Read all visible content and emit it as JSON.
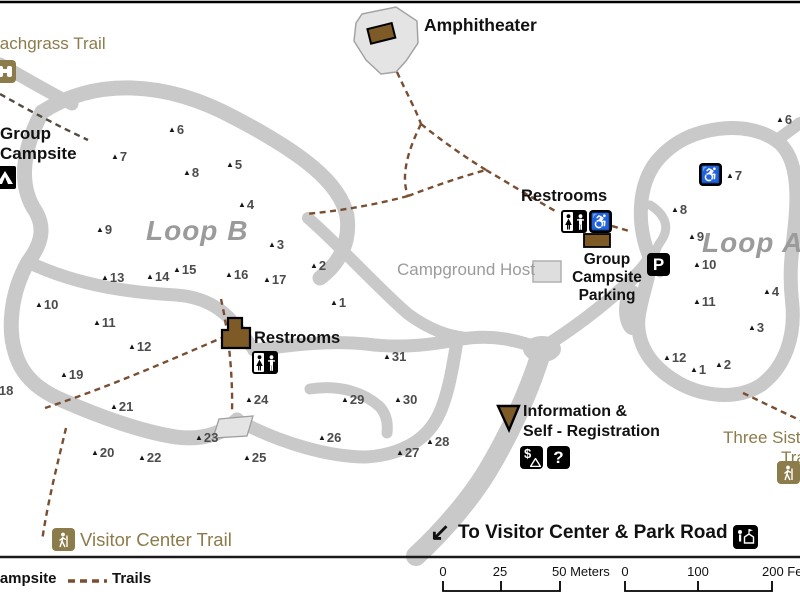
{
  "labels": {
    "beachgrass_trail": "Beachgrass Trail",
    "amphitheater": "Amphitheater",
    "group_campsite_line1": "Group",
    "group_campsite_line2": "Campsite",
    "loop_b": "Loop B",
    "loop_a": "Loop A",
    "restrooms_loop_b": "Restrooms",
    "restrooms_loop_a": "Restrooms",
    "campground_host": "Campground Host",
    "group_campsite_parking_line1": "Group",
    "group_campsite_parking_line2": "Campsite",
    "group_campsite_parking_line3": "Parking",
    "information_line1": "Information &",
    "information_line2": "Self - Registration",
    "three_sisters_line1": "Three Sisters",
    "three_sisters_line2": "Trail",
    "visitor_center_trail": "Visitor Center Trail",
    "to_visitor_center": "To Visitor Center & Park Road"
  },
  "icons": {
    "arrow_sw": "↙",
    "parking": "P",
    "question": "?",
    "dollar": "$",
    "wheelchair": "♿",
    "campsite_triangle": "▲"
  },
  "legend": {
    "campsite": "Campsite",
    "trails": "Trails"
  },
  "scale_bars": {
    "meters": {
      "labels": [
        {
          "text": "0",
          "x": 443,
          "anchor": "middle"
        },
        {
          "text": "25",
          "x": 500,
          "anchor": "middle"
        },
        {
          "text": "50 Meters",
          "x": 552,
          "anchor": "start"
        }
      ]
    },
    "feet": {
      "labels": [
        {
          "text": "0",
          "x": 625,
          "anchor": "middle"
        },
        {
          "text": "100",
          "x": 698,
          "anchor": "middle"
        },
        {
          "text": "200 Feet",
          "x": 762,
          "anchor": "start"
        }
      ]
    }
  },
  "sites": {
    "loop_b": [
      {
        "n": "1",
        "x": 330,
        "y": 296
      },
      {
        "n": "2",
        "x": 310,
        "y": 259
      },
      {
        "n": "3",
        "x": 268,
        "y": 238
      },
      {
        "n": "4",
        "x": 238,
        "y": 198
      },
      {
        "n": "5",
        "x": 226,
        "y": 158
      },
      {
        "n": "6",
        "x": 168,
        "y": 123
      },
      {
        "n": "7",
        "x": 111,
        "y": 150
      },
      {
        "n": "8",
        "x": 183,
        "y": 166
      },
      {
        "n": "9",
        "x": 96,
        "y": 223
      },
      {
        "n": "10",
        "x": 35,
        "y": 298
      },
      {
        "n": "11",
        "x": 93,
        "y": 316
      },
      {
        "n": "12",
        "x": 128,
        "y": 340
      },
      {
        "n": "13",
        "x": 101,
        "y": 271
      },
      {
        "n": "14",
        "x": 146,
        "y": 270
      },
      {
        "n": "15",
        "x": 173,
        "y": 263
      },
      {
        "n": "16",
        "x": 225,
        "y": 268
      },
      {
        "n": "17",
        "x": 263,
        "y": 273
      },
      {
        "n": "18",
        "x": -10,
        "y": 384
      },
      {
        "n": "19",
        "x": 60,
        "y": 368
      },
      {
        "n": "20",
        "x": 91,
        "y": 446
      },
      {
        "n": "21",
        "x": 110,
        "y": 400
      },
      {
        "n": "22",
        "x": 138,
        "y": 451
      },
      {
        "n": "23",
        "x": 195,
        "y": 431
      },
      {
        "n": "24",
        "x": 245,
        "y": 393
      },
      {
        "n": "25",
        "x": 243,
        "y": 451
      },
      {
        "n": "26",
        "x": 318,
        "y": 431
      },
      {
        "n": "27",
        "x": 396,
        "y": 446
      },
      {
        "n": "28",
        "x": 426,
        "y": 435
      },
      {
        "n": "29",
        "x": 341,
        "y": 393
      },
      {
        "n": "30",
        "x": 394,
        "y": 393
      },
      {
        "n": "31",
        "x": 383,
        "y": 350
      }
    ],
    "loop_a": [
      {
        "n": "1",
        "x": 690,
        "y": 363
      },
      {
        "n": "2",
        "x": 715,
        "y": 358
      },
      {
        "n": "3",
        "x": 748,
        "y": 321
      },
      {
        "n": "4",
        "x": 763,
        "y": 285
      },
      {
        "n": "6",
        "x": 776,
        "y": 113
      },
      {
        "n": "7",
        "x": 726,
        "y": 169
      },
      {
        "n": "8",
        "x": 671,
        "y": 203
      },
      {
        "n": "9",
        "x": 688,
        "y": 230
      },
      {
        "n": "10",
        "x": 693,
        "y": 258
      },
      {
        "n": "11",
        "x": 693,
        "y": 295
      },
      {
        "n": "12",
        "x": 663,
        "y": 351
      }
    ]
  },
  "colors": {
    "road": "#c9c9c9",
    "trail": "#7a4e30",
    "beachgrass_trail": "#534a40",
    "khaki": "#8c7b4b",
    "building_brown": "#7d5a26",
    "loop_label_gray": "#9b9b9b",
    "site_number_gray": "#4b4b4b"
  }
}
